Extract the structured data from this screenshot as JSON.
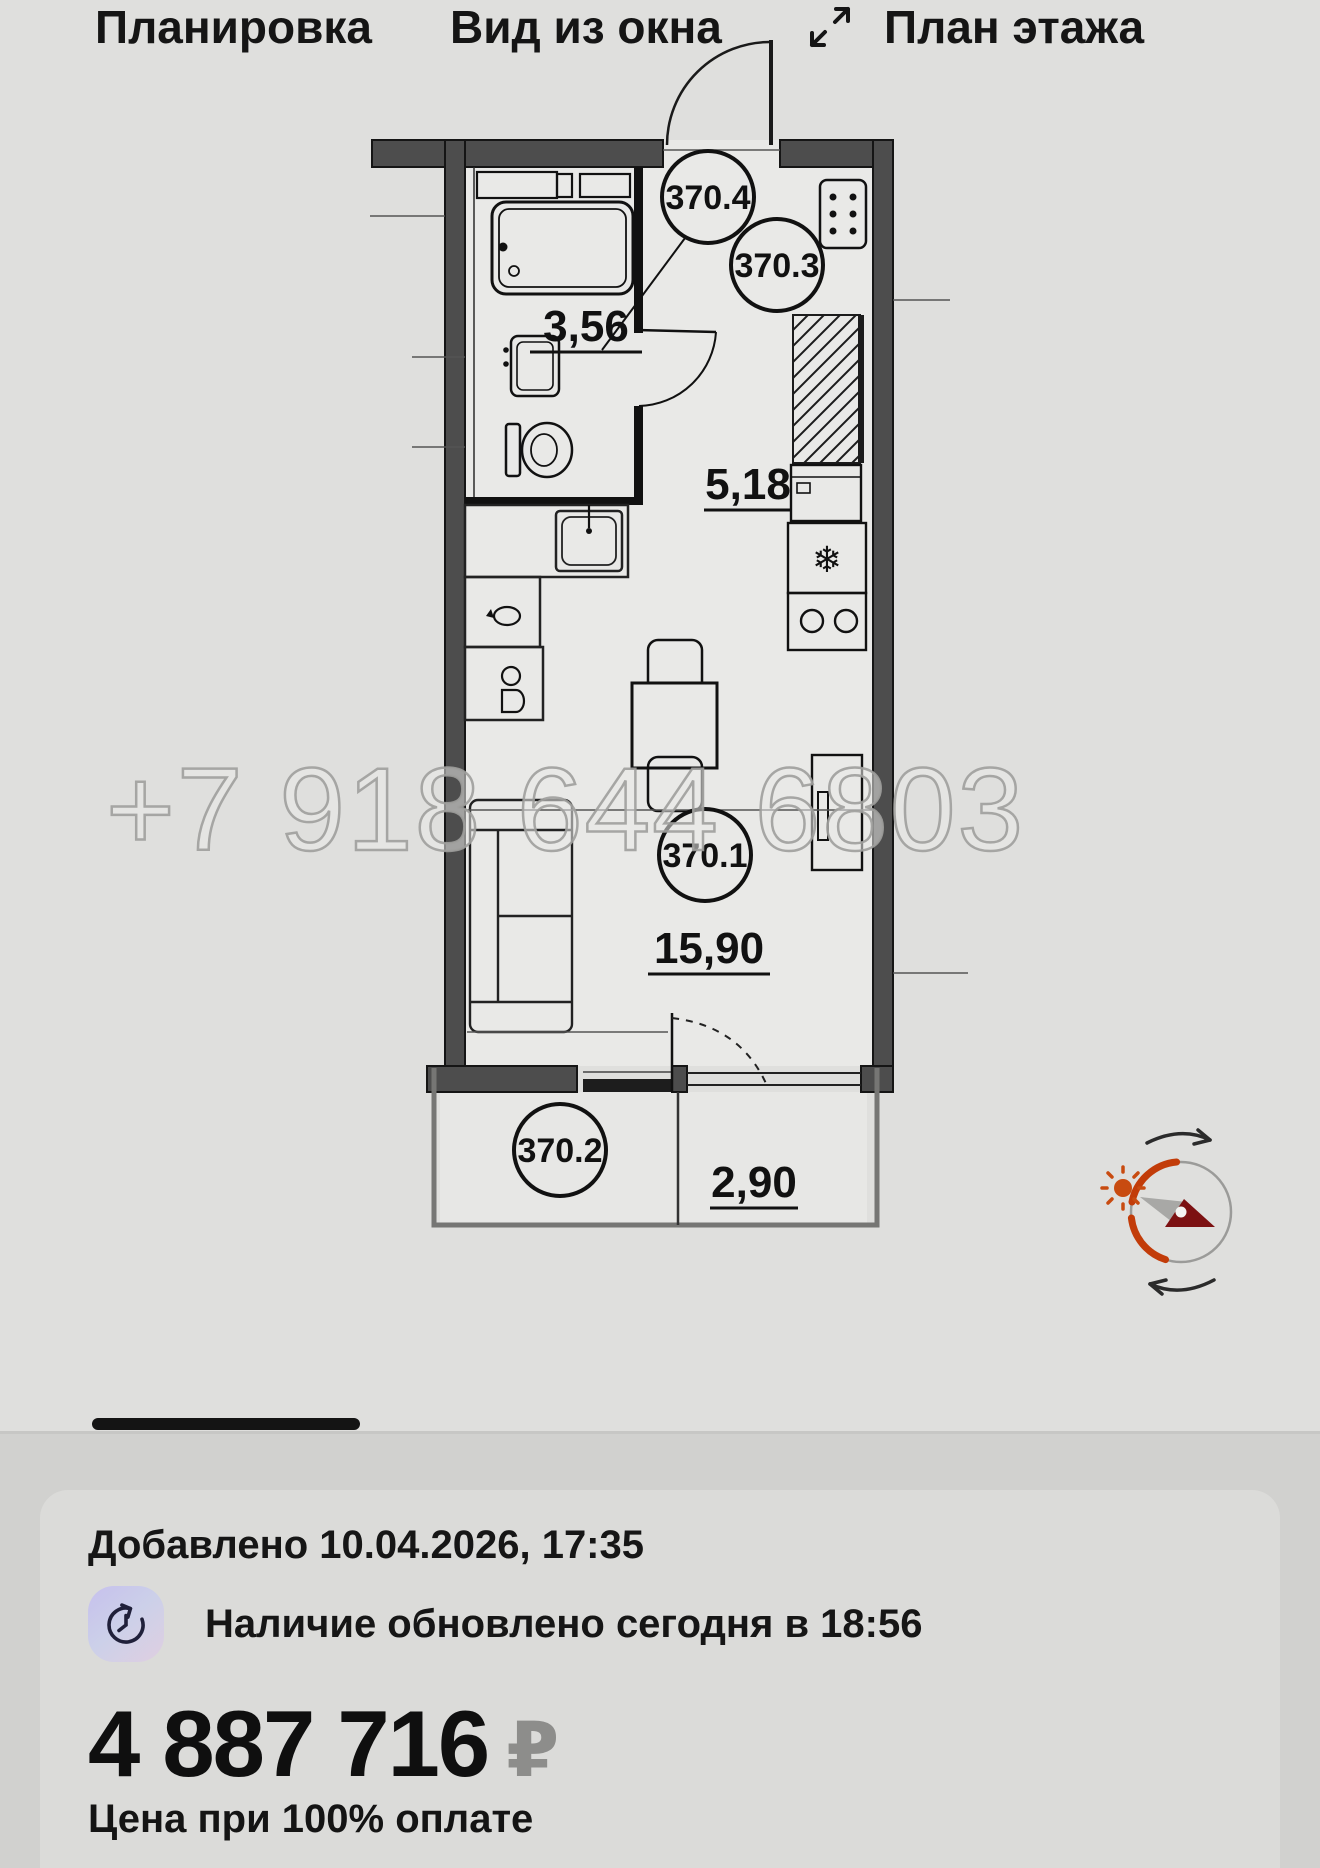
{
  "plan": {
    "watermark": "+7 918 644 6803",
    "rooms": [
      {
        "id": "370.4",
        "area": "3,56"
      },
      {
        "id": "370.3",
        "area": "5,18"
      },
      {
        "id": "370.1",
        "area": "15,90"
      },
      {
        "id": "370.2",
        "area": "2,90"
      }
    ],
    "fridge_glyph": "❄"
  },
  "tabs": {
    "items": [
      {
        "label": "Планировка",
        "active": true
      },
      {
        "label": "Вид из окна",
        "active": false
      },
      {
        "label": "План этажа",
        "active": false,
        "icon": "expand-icon"
      }
    ]
  },
  "card": {
    "added": "Добавлено 10.04.2026, 17:35",
    "availability": "Наличие обновлено сегодня в 18:56",
    "price_amount": "4 887 716",
    "price_currency": "₽",
    "price_note": "Цена при 100% оплате"
  },
  "colors": {
    "sun_path_orange": "#c23c09",
    "needle_red": "#7c1112",
    "needle_gray": "#a8a8a6",
    "tab_active_underline": "#141414",
    "walls": "#4d4d4d"
  }
}
